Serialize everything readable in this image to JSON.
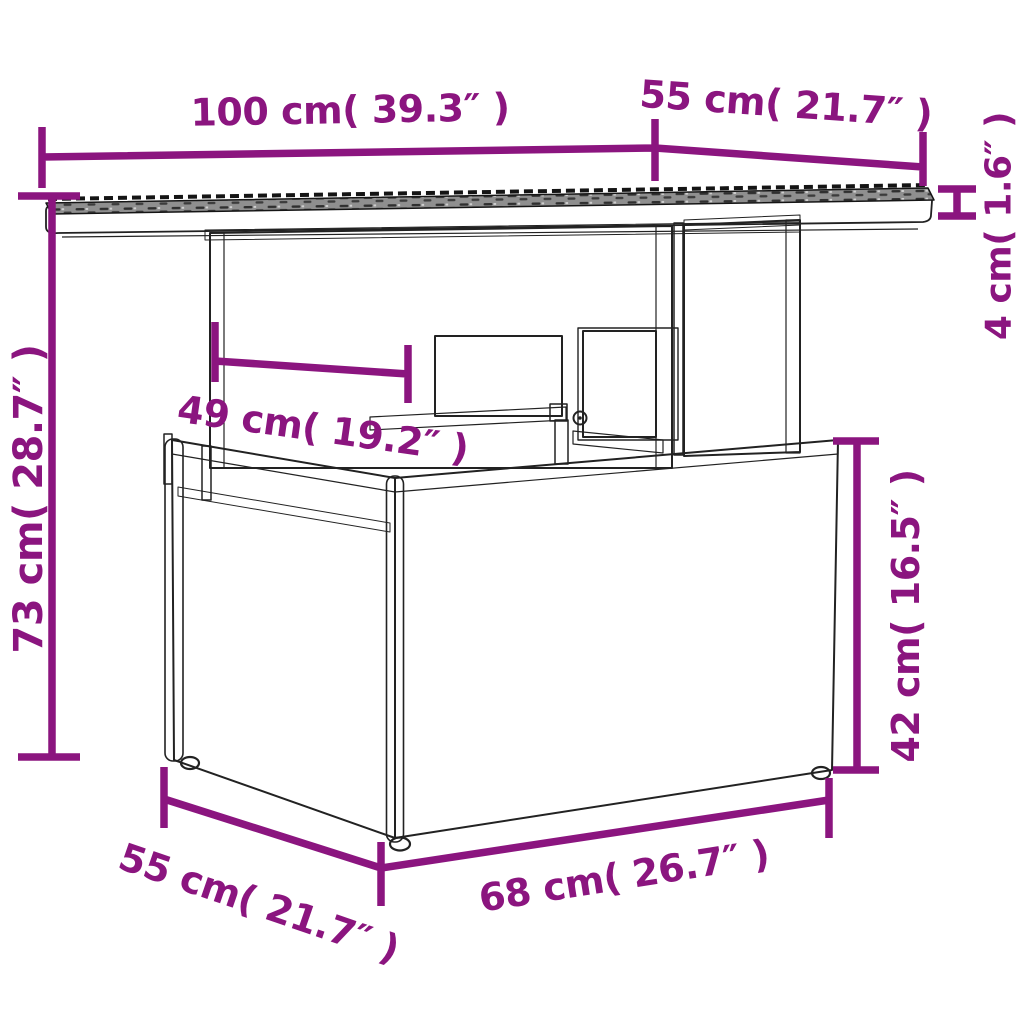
{
  "diagram": {
    "type": "product-dimension-diagram",
    "product": "rattan-lift-top-garden-table",
    "background": "#ffffff",
    "accent_color": "#8b157f",
    "outline_color": "#222222",
    "tabletop_surface_color": "#8f8f8f"
  },
  "dimensions": {
    "table_top_length": {
      "label": "100 cm( 39.3″ )",
      "cm": 100,
      "inch": 39.3
    },
    "table_top_depth": {
      "label": "55 cm( 21.7″ )",
      "cm": 55,
      "inch": 21.7
    },
    "table_top_thickness": {
      "label": "4 cm( 1.6″ )",
      "cm": 4,
      "inch": 1.6
    },
    "total_height": {
      "label": "73 cm( 28.7″ )",
      "cm": 73,
      "inch": 28.7
    },
    "support_opening_width": {
      "label": "49 cm( 19.2″ )",
      "cm": 49,
      "inch": 19.2
    },
    "base_height": {
      "label": "42 cm( 16.5″ )",
      "cm": 42,
      "inch": 16.5
    },
    "base_depth": {
      "label": "55 cm( 21.7″ )",
      "cm": 55,
      "inch": 21.7
    },
    "base_length": {
      "label": "68 cm( 26.7″ )",
      "cm": 68,
      "inch": 26.7
    }
  }
}
